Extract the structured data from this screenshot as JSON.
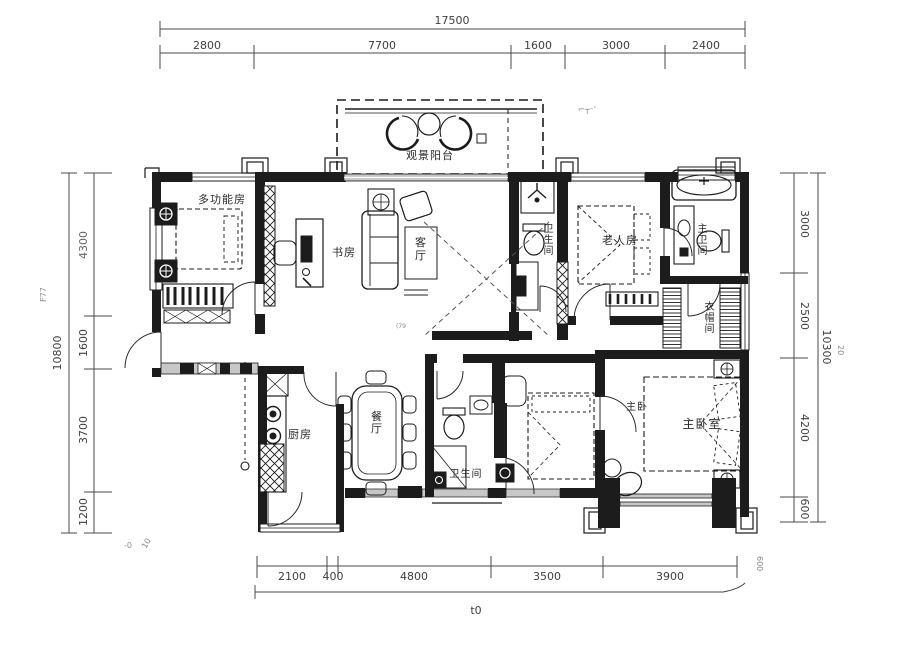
{
  "plan": {
    "rooms": {
      "multi": "多功能房",
      "study": "书房",
      "living": "客厅",
      "balcony": "观景阳台",
      "bath_top": "卫生间",
      "elder": "老人房",
      "master_bath": "主卫间",
      "cloak": "衣帽间",
      "kitchen": "厨房",
      "dining": "餐厅",
      "bath_bottom": "卫生间",
      "master_small": "主卧",
      "master": "主卧室"
    }
  },
  "dims": {
    "top": {
      "total": "17500",
      "segments": [
        "2800",
        "7700",
        "1600",
        "3000",
        "2400"
      ]
    },
    "left": {
      "total": "10800",
      "segments": [
        "4300",
        "1600",
        "3700",
        "1200"
      ]
    },
    "right": {
      "total": "10300",
      "segments": [
        "3000",
        "2500",
        "4200",
        "600"
      ]
    },
    "bottom": {
      "total": "t0",
      "segments": [
        "2100",
        "400",
        "4800",
        "3500",
        "3900"
      ]
    }
  },
  "artifacts": {
    "top_right_marks": "⌐┬⁻'",
    "left_margin_marks": "F77",
    "right_mark_20": "20",
    "right_mark_600": "600",
    "bottom_left_mark1": "-0",
    "bottom_left_mark2": "10",
    "tiny_mark_dp": "(79"
  },
  "colors": {
    "ink": "#1c1c1c",
    "wall_gray": "#b9b9b9",
    "dim": "#3f3f3f"
  }
}
